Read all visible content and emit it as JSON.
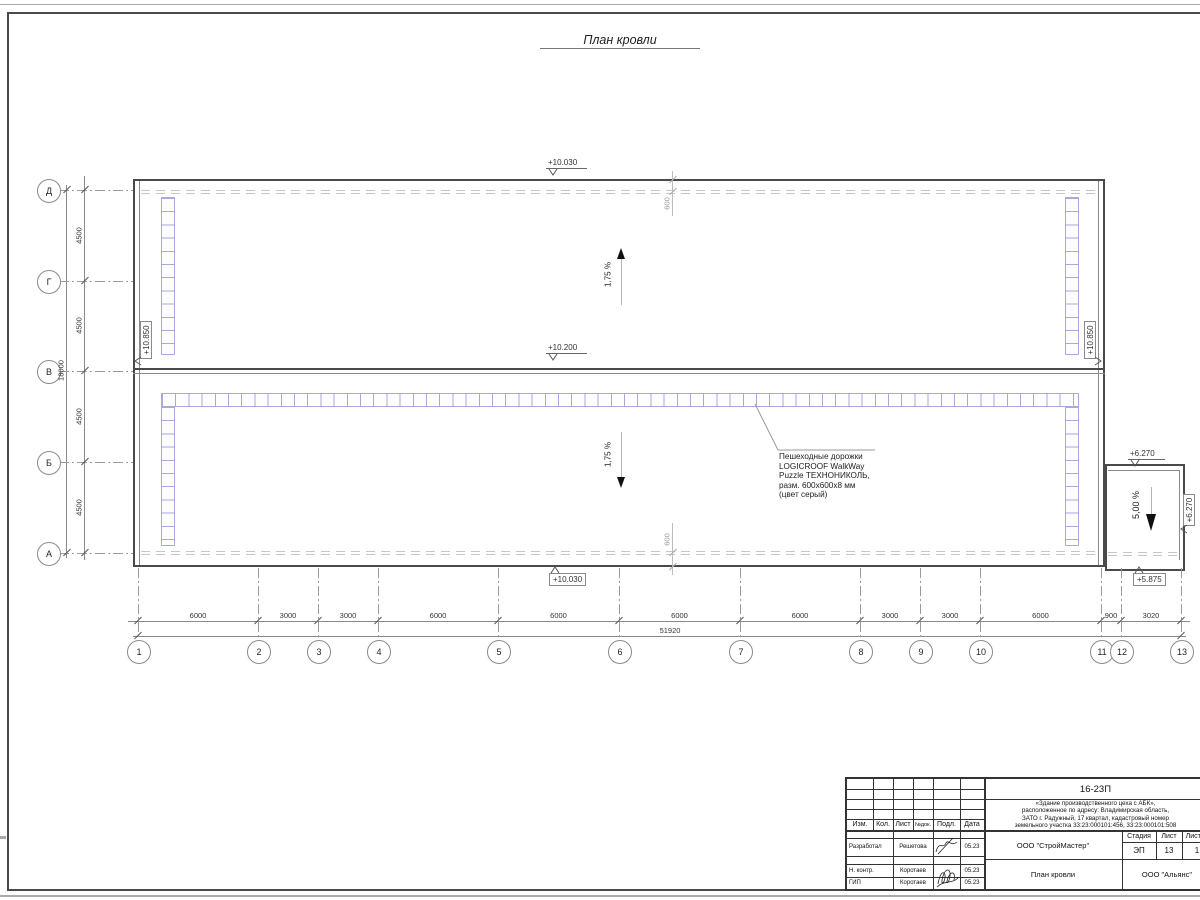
{
  "drawing_title": "План кровли",
  "grid": {
    "col_axes": [
      "1",
      "2",
      "3",
      "4",
      "5",
      "6",
      "7",
      "8",
      "9",
      "10",
      "11",
      "12",
      "13"
    ],
    "row_axes": [
      "Д",
      "Г",
      "В",
      "Б",
      "А"
    ],
    "col_dims": [
      "6000",
      "3000",
      "3000",
      "6000",
      "6000",
      "6000",
      "6000",
      "3000",
      "3000",
      "6000",
      "900",
      "3020"
    ],
    "col_total": "51920",
    "row_dims": [
      "4500",
      "4500",
      "4500",
      "4500"
    ],
    "row_total": "18000"
  },
  "elevations": {
    "roof_top": "+10.030",
    "roof_mid": "+10.200",
    "roof_bottom": "+10.030",
    "parapet_left": "+10.850",
    "parapet_right": "+10.850",
    "annex_top": "+6.270",
    "annex_right": "+6.270",
    "annex_bottom": "+5.875"
  },
  "slopes": {
    "upper": "1,75 %",
    "lower": "1,75 %",
    "annex": "5,00 %"
  },
  "parapet_offset_dim": "600",
  "walkway_note": {
    "line1": "Пешеходные дорожки",
    "line2": "LOGICROOF WalkWay",
    "line3": "Puzzle ТЕХНОНИКОЛЬ,",
    "line4": "разм. 600х600х8 мм",
    "line5": "(цвет серый)"
  },
  "title_block": {
    "doc_number": "16-23П",
    "description_lines": [
      "«Здание производственного цеха с АБК»,",
      "расположенное по адресу: Владимирская область,",
      "ЗАТО г. Радужный, 17 квартал, кадастровый номер",
      "земельного участка 33:23:000101:456, 33:23:000101:508"
    ],
    "header_cols": [
      "Изм.",
      "Кол.",
      "Лист",
      "№док.",
      "Подл.",
      "Дата"
    ],
    "rows": [
      {
        "role": "Разработал",
        "name": "Решетова",
        "date": "05.23"
      },
      {
        "role": "Н. контр.",
        "name": "Коротаев",
        "date": "05.23"
      },
      {
        "role": "ГИП",
        "name": "Коротаев",
        "date": "05.23"
      }
    ],
    "company": "ООО \"СтройМастер\"",
    "stage_label": "Стадия",
    "sheet_label": "Лист",
    "sheets_label": "Листов",
    "stage_value": "ЭП",
    "sheet_value": "13",
    "sheets_value": "1",
    "sheet_title": "План кровли",
    "contractor": "ООО \"Альянс\""
  },
  "colors": {
    "walkway": "#a9a9e0",
    "wall_dark": "#4a4a4a",
    "dim_gray": "#8a8a8a"
  }
}
